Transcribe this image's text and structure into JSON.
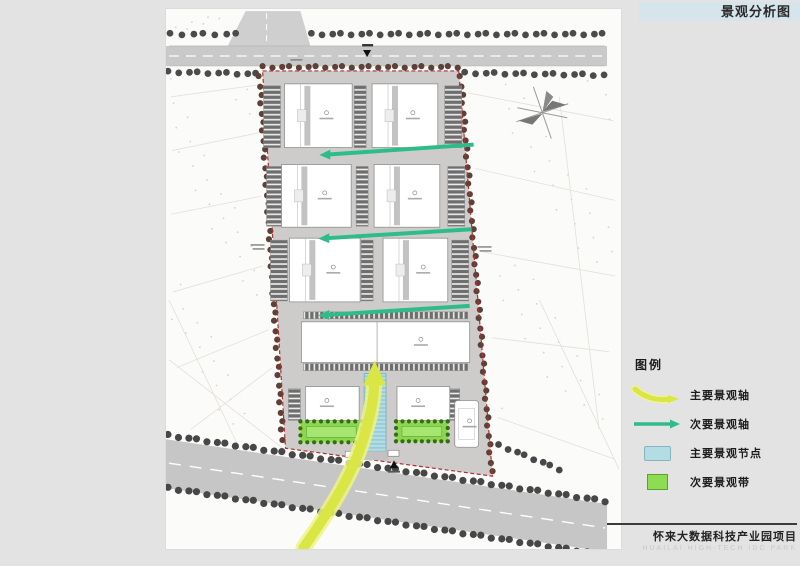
{
  "header": {
    "title": "景观分析图"
  },
  "legend": {
    "heading": "图例",
    "items": [
      {
        "id": "main-axis",
        "label": "主要景观轴"
      },
      {
        "id": "secondary-axis",
        "label": "次要景观轴"
      },
      {
        "id": "main-node",
        "label": "主要景观节点"
      },
      {
        "id": "secondary-belt",
        "label": "次要景观带"
      }
    ]
  },
  "footer": {
    "project_title": "怀来大数据科技产业园项目",
    "project_subtitle": "HUAILAI HIGH-TECH IDC PARK"
  },
  "colors": {
    "title_bar_bg": "#d6e4eb",
    "main_axis": "#d9e643",
    "secondary_axis": "#2ebd8a",
    "main_node": "#b3dde4",
    "secondary_belt": "#8ddd52",
    "site_boundary": "#b03030"
  }
}
